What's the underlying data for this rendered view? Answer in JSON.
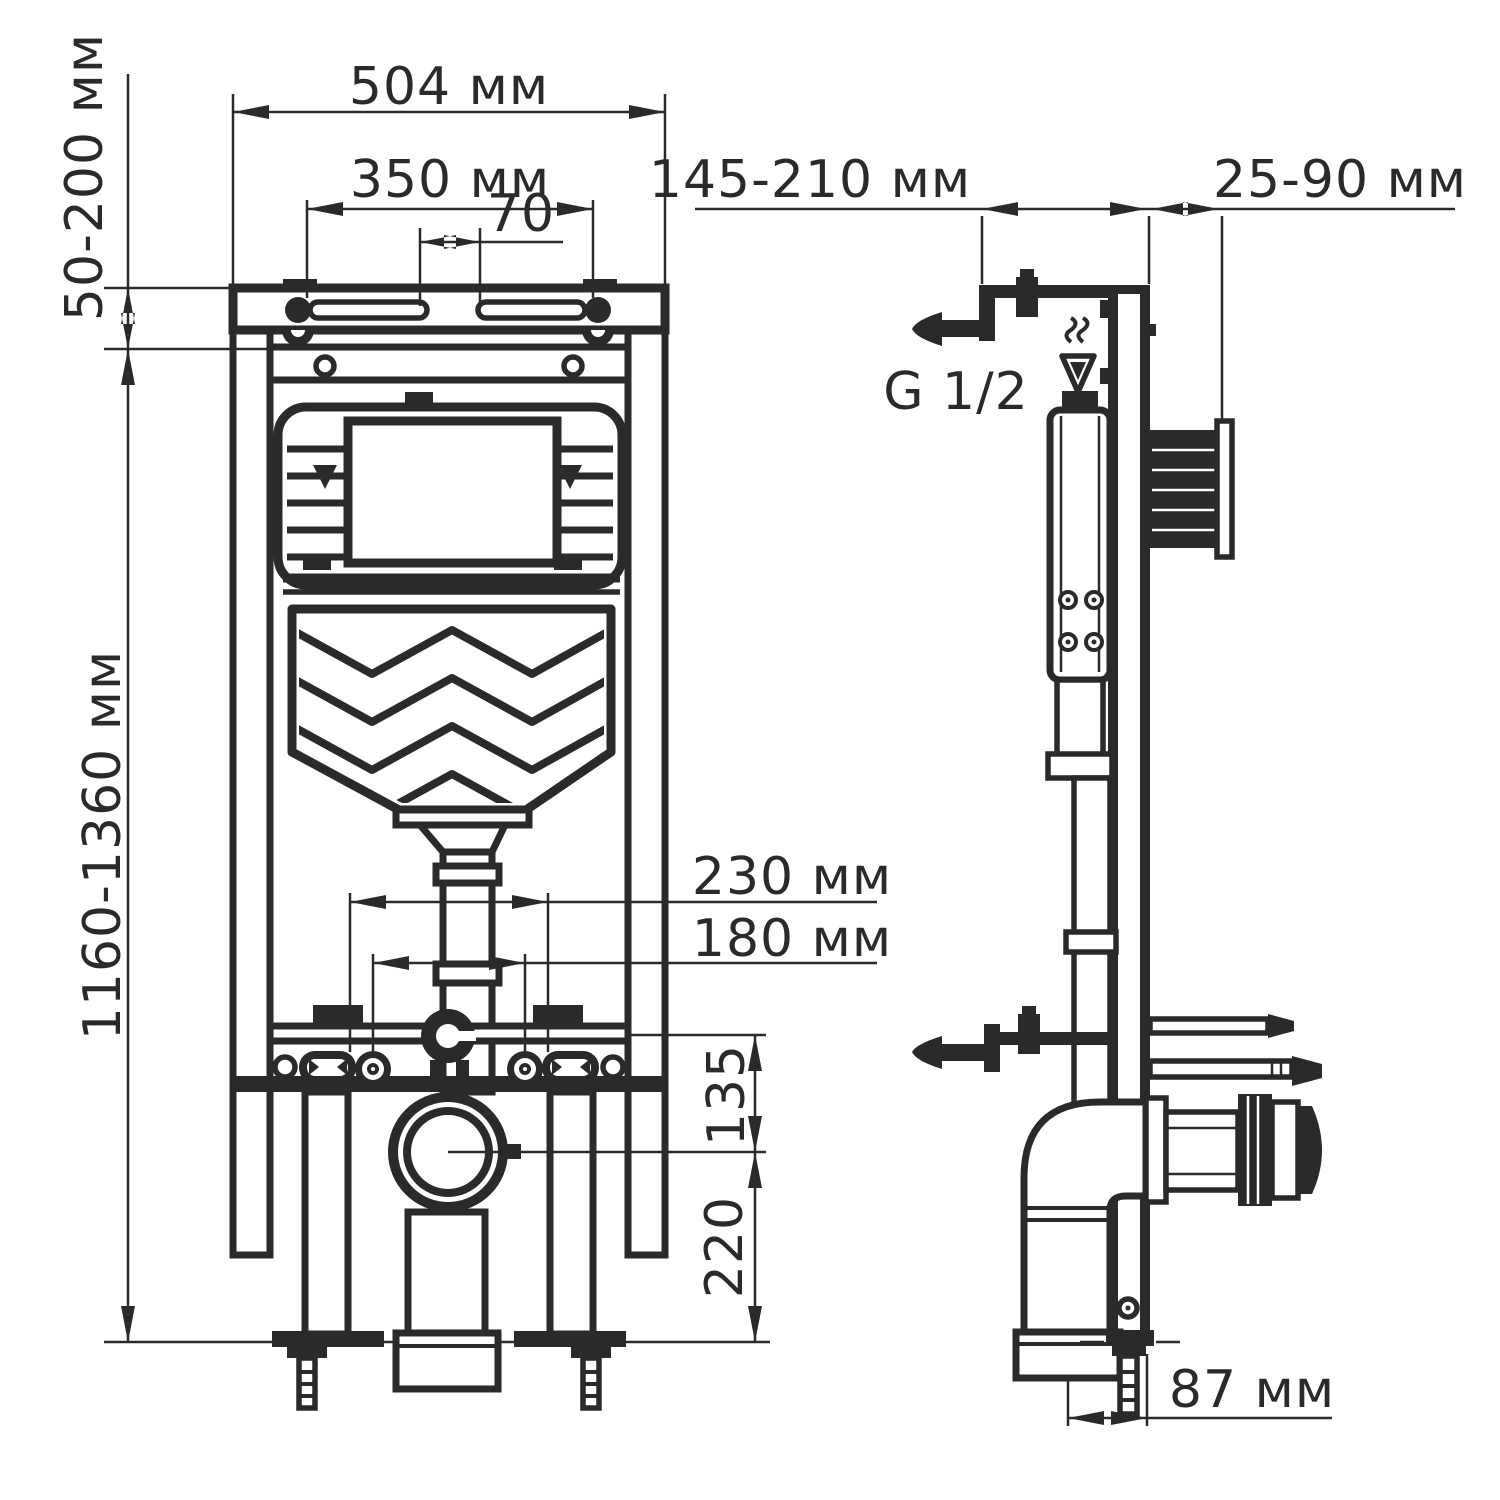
{
  "front_view": {
    "outer_width": "504 мм",
    "bolt_spacing": "350 мм",
    "slot_gap": "70",
    "top_bracket_range": "50-200 мм",
    "height_range": "1160-1360 мм",
    "fixing_spacing_outer": "230 мм",
    "fixing_spacing_inner": "180 мм",
    "outlet_to_rail": "135",
    "outlet_to_floor": "220"
  },
  "side_view": {
    "depth_range": "145-210 мм",
    "wall_offset_range": "25-90 мм",
    "water_connection": "G 1/2",
    "outlet_offset": "87 мм"
  },
  "colors": {
    "line": "#2b2a29",
    "background": "#ffffff"
  }
}
